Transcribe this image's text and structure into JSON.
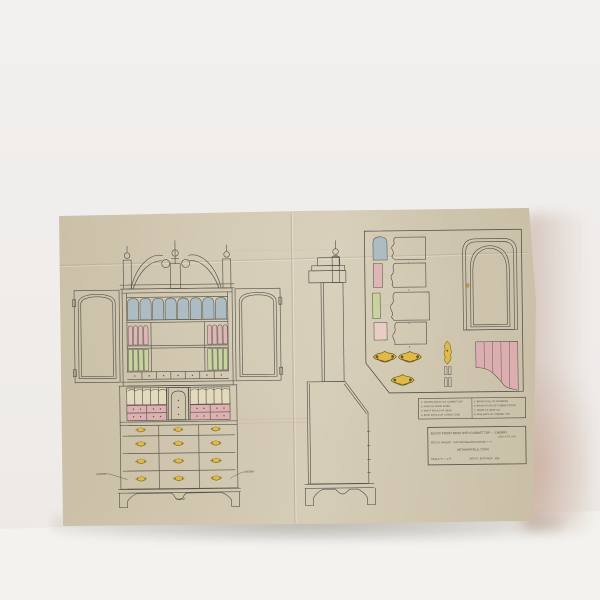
{
  "colors": {
    "wall": "#f0eeec",
    "floor": "#f3f2ef",
    "paper": "#d0c6af",
    "ink": "#57554d",
    "panel_blue": "#adbbc3",
    "panel_pink": "#deb6b6",
    "panel_green": "#c9d39e",
    "pigeonhole_cream": "#e3d9bd",
    "brass_yellow": "#e0ba48",
    "guide_pink": "#d49f96",
    "shadow_warm": "#cfae9d"
  },
  "front_elevation": {
    "label_left": "CHERRY",
    "label_right": "CHERRY",
    "label_bottom": "FRONT"
  },
  "detail_panel": {
    "numbers": [
      "1",
      "2",
      "3",
      "4"
    ]
  },
  "legend": {
    "items": [
      "1- CROWN MOULD OF CABINET TOP",
      "2- ARCH OF DOOR PANEL",
      "3- WAIST MOULD OF DESK",
      "4- BASE MOULD OF LOWER CASE",
      "5- BRASS PULL OF DRAWERS",
      "6- BRASS PLATE OF CABINET DOOR",
      "7- HINGE OF DESK LID",
      "8- PINE BACK OF CABINET TOP"
    ]
  },
  "title_block": {
    "line1": "BLOCK FRONT DESK WITH CABINET TOP - - CHERRY",
    "line1b": "CIRCA 1750-1780",
    "line2": "SOUTH PARLOR · CAPTAIN BELDEN HOUSE + + +",
    "line3": "WETHERSFIELD, CONN.",
    "scale": "SCALE ¾\" = 1'-0\"",
    "credit": "JACK R. BUCHNER · DEL."
  }
}
